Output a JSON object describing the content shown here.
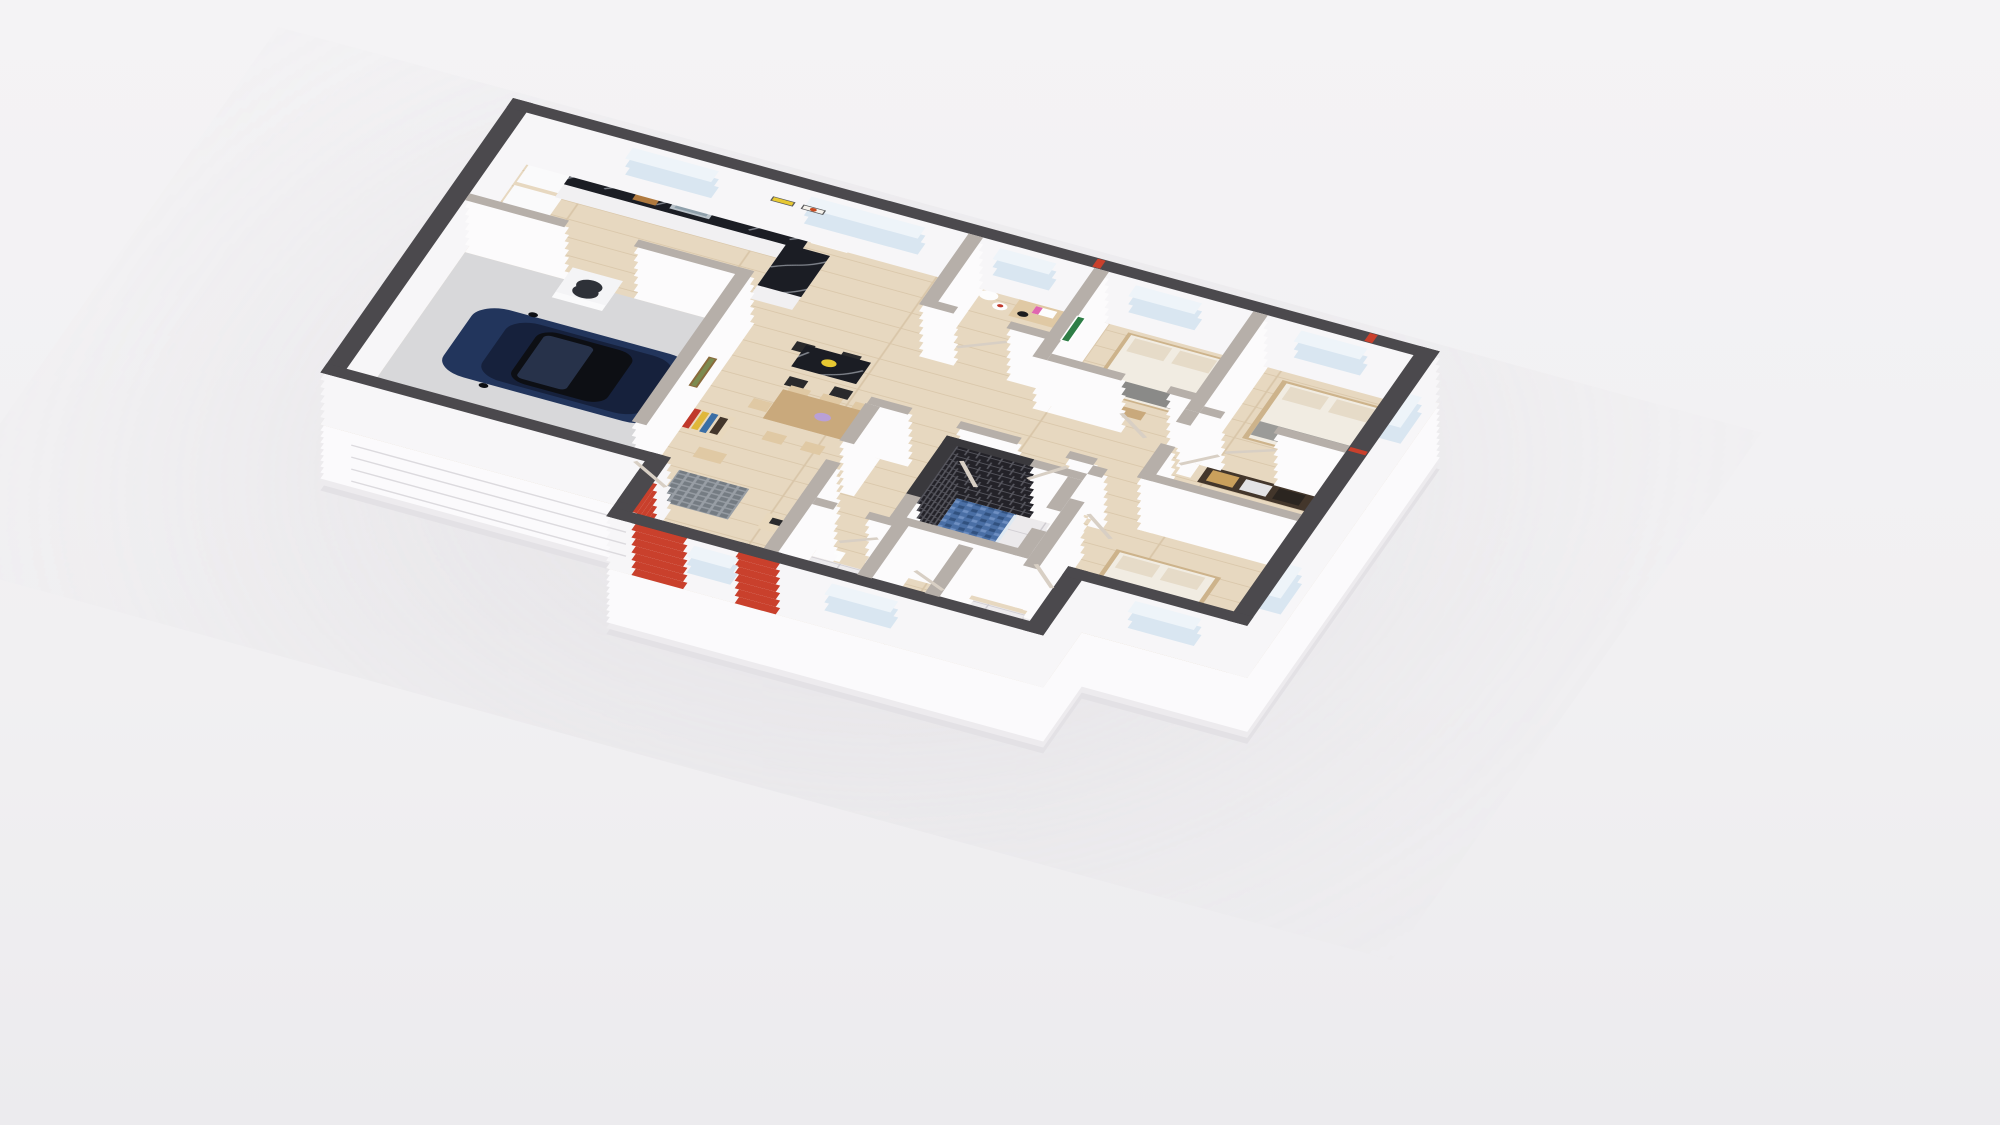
{
  "scene": {
    "label": "3D isometric cutaway floor plan render of a single-storey house",
    "type": "3d-floorplan-render",
    "view": "isometric-top-down",
    "background": "#f2f1f3",
    "rooms": [
      {
        "id": "garage",
        "furniture": [
          "navy-car",
          "stacked-washer-dryer",
          "garage-door"
        ]
      },
      {
        "id": "kitchen",
        "furniture": [
          "wall-cabinets",
          "fridge-column",
          "black-marble-counter",
          "sink",
          "faucet",
          "cutting-board",
          "window"
        ]
      },
      {
        "id": "dining-area",
        "furniture": [
          "black-marble-high-table",
          "4-black-chairs",
          "wood-dining-table",
          "6-wood-chairs",
          "purple-vase",
          "yellow-plate"
        ]
      },
      {
        "id": "living-entry",
        "furniture": [
          "bookshelf",
          "storage-crate",
          "entry-mat",
          "console-table",
          "front-door-glass",
          "red-accent-walls",
          "landscape-painting"
        ]
      },
      {
        "id": "office",
        "furniture": [
          "desk",
          "laptop",
          "headphones",
          "chair",
          "dried-branch-vases",
          "window"
        ]
      },
      {
        "id": "bedroom-1",
        "furniture": [
          "double-bed",
          "pillows",
          "gray-runner",
          "foot-bench",
          "stained-glass-artwork",
          "window"
        ]
      },
      {
        "id": "master-bedroom",
        "furniture": [
          "double-bed",
          "gray-runner",
          "nightstand",
          "pendant-lamp",
          "windows"
        ]
      },
      {
        "id": "walk-in-closet",
        "furniture": [
          "open-shelving",
          "storage-boxes",
          "folded-clothes"
        ]
      },
      {
        "id": "bedroom-2",
        "furniture": [
          "double-bed",
          "gray-runner",
          "windows"
        ]
      },
      {
        "id": "bathroom",
        "furniture": [
          "black-tile-shower",
          "blue-mosaic-shower-floor",
          "glass-partition",
          "shower-head",
          "toilet",
          "white-tile-floor"
        ]
      },
      {
        "id": "wc",
        "furniture": [
          "toilet",
          "corner-sink",
          "white-tile-floor"
        ]
      },
      {
        "id": "hallway",
        "furniture": [
          "open-wood-doors"
        ]
      }
    ],
    "artworks": [
      "sunflower-yellow-print",
      "red-starburst-print",
      "green-stained-glass-panel",
      "gold-framed-landscape"
    ],
    "counts": {
      "bedrooms": 3,
      "dining_chairs": 6,
      "bar_chairs": 4,
      "red_accent_walls": 3,
      "open_doors": 11,
      "toilets": 2,
      "showers": 2
    }
  },
  "colors": {
    "background": "#f2f1f3",
    "ground_shadow": "#c8c4cb",
    "exterior_body": "#f7f6f8",
    "exterior_cap": "#4b494d",
    "interior_body": "#fcfbfc",
    "interior_cap": "#b6afa9",
    "red_accent": "#c9402c",
    "dark_tile_wall": "#232228",
    "floor_wood": "#e7d8c0",
    "garage_slab": "#d8d8da",
    "bath_tile": "#eceaec",
    "shower_mosaic_blue": "#4a6fa5",
    "entry_mat": "#989ea5",
    "marble_black": "#1b1d24",
    "car_navy": "#22355c",
    "car_roof": "#0d0f14",
    "glass": "#d9e6f1",
    "door_wood": "#d8cfc4",
    "artwork_green": "#2e7d46",
    "artwork_yellow": "#e7c832",
    "artwork_redburst": "#c84b20",
    "landscape_green": "#7c8a4f",
    "plinth_white": "#fbfafc"
  }
}
